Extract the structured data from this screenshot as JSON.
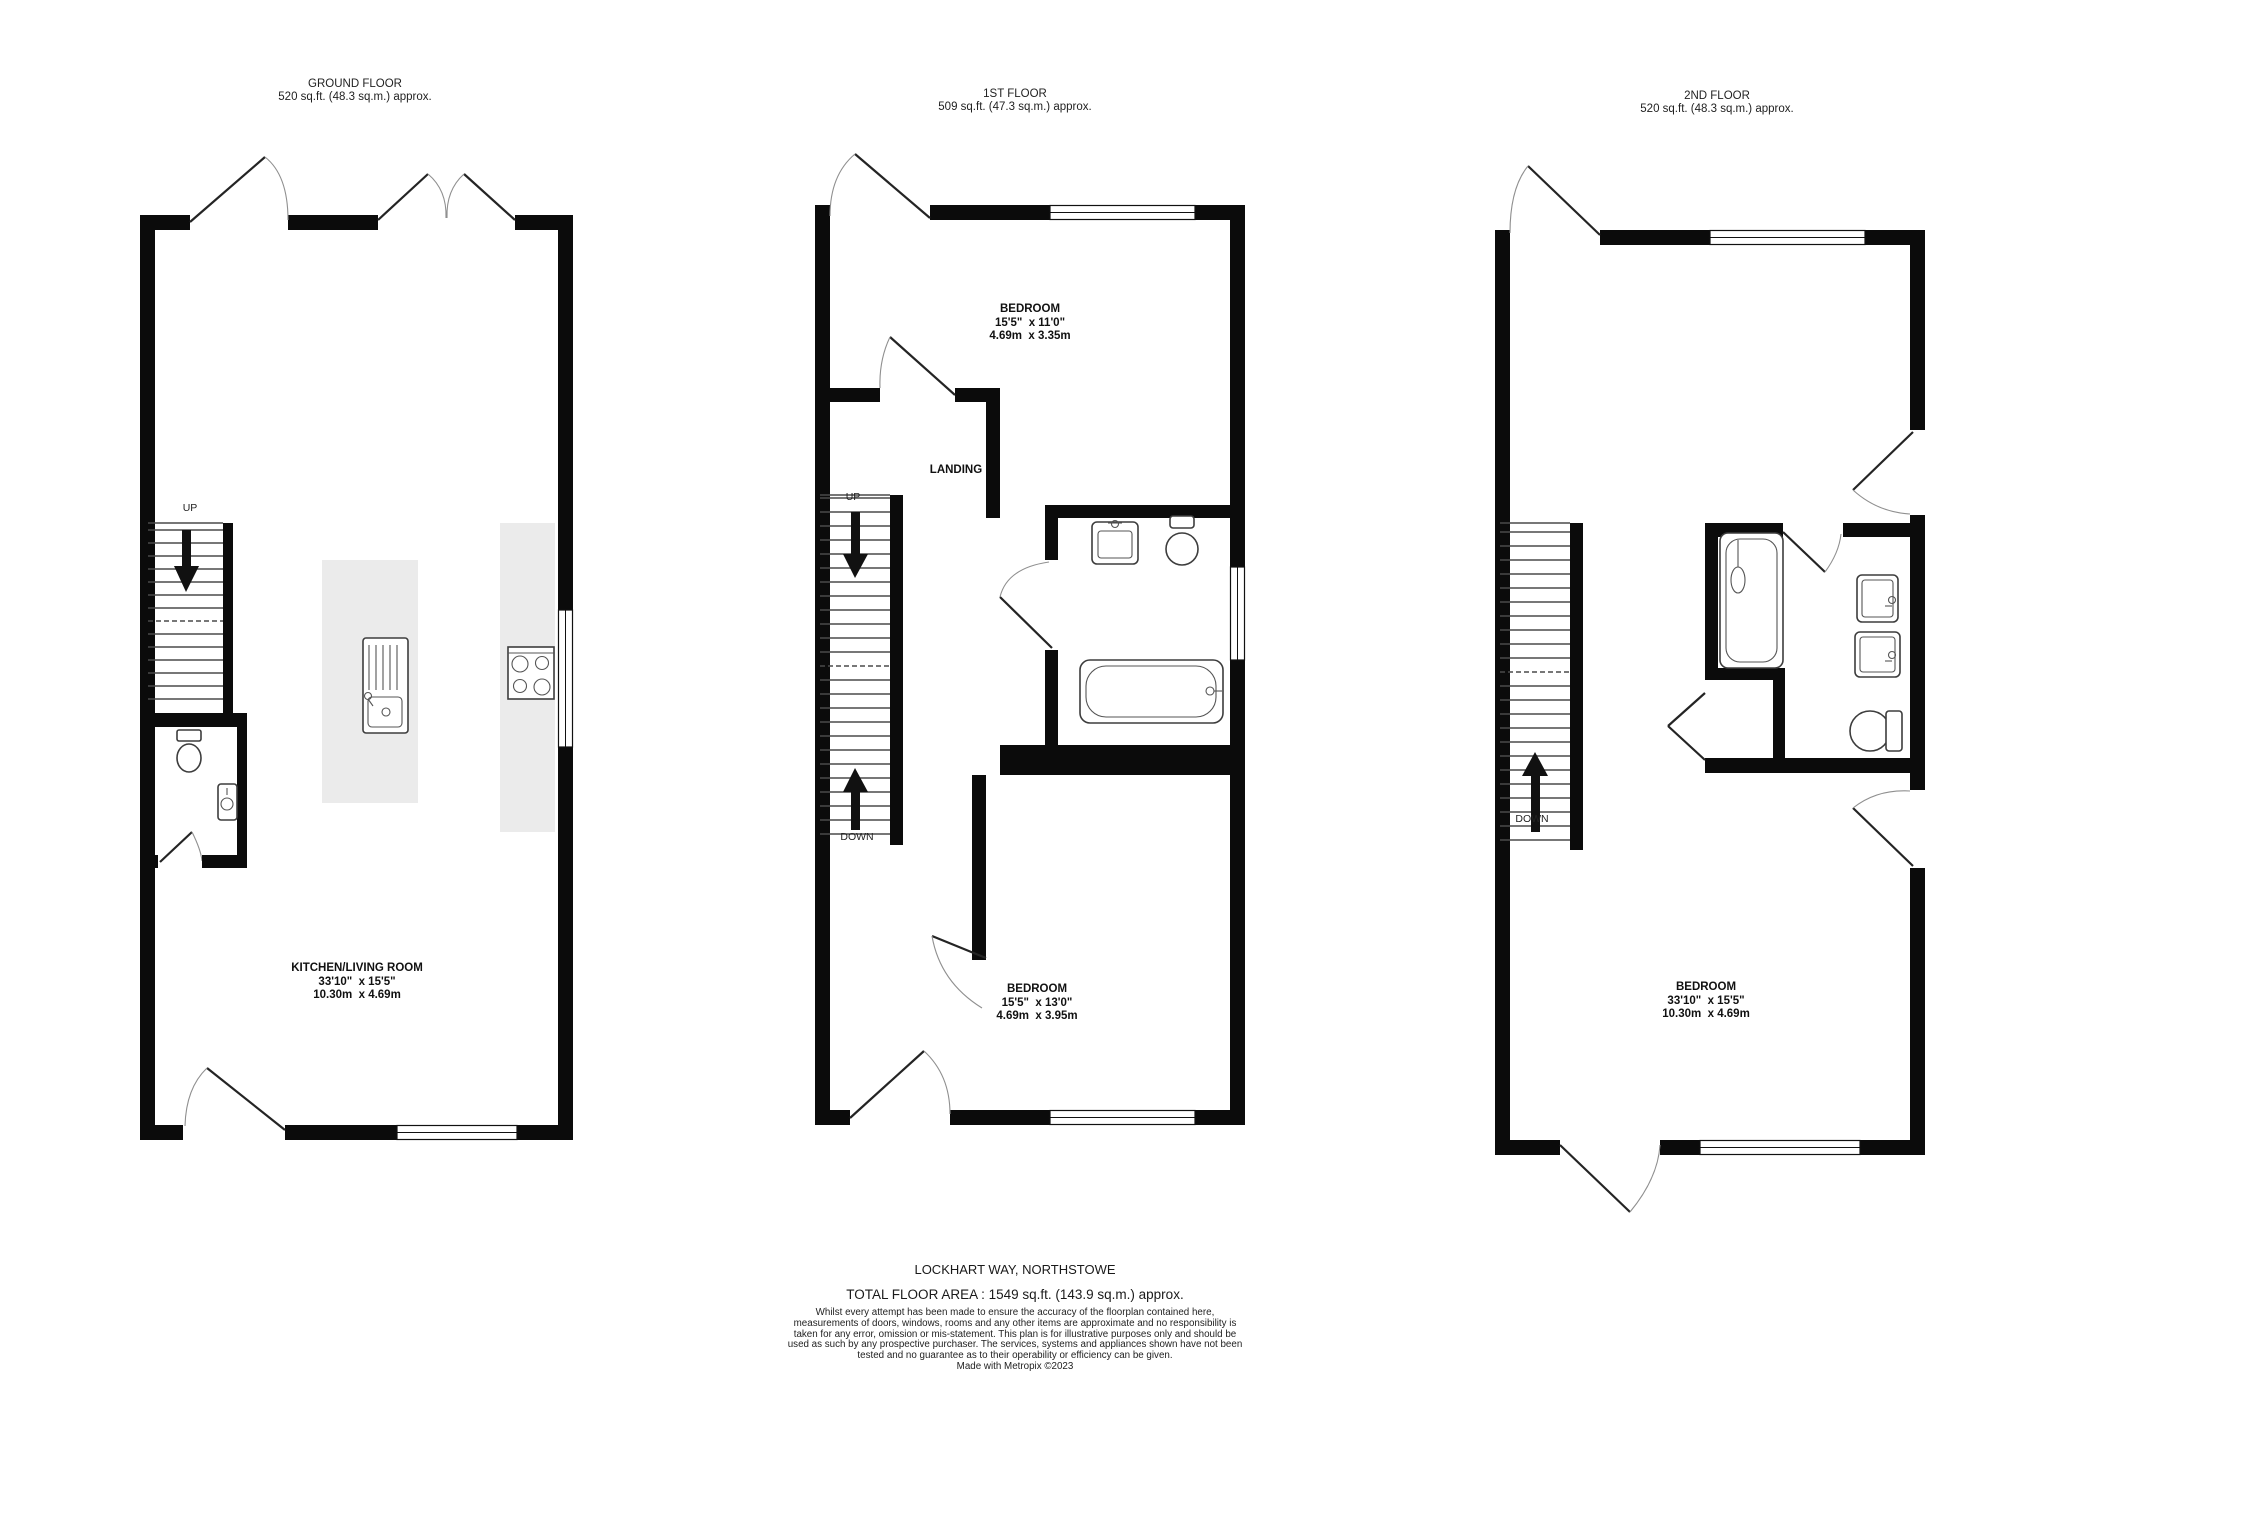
{
  "floors": [
    {
      "id": "ground",
      "title": "GROUND FLOOR",
      "area": "520 sq.ft. (48.3 sq.m.) approx.",
      "rooms": [
        {
          "name": "KITCHEN/LIVING ROOM",
          "dims_imperial": "33'10\"  x 15'5\"",
          "dims_metric": "10.30m  x 4.69m"
        }
      ],
      "stairs": {
        "up_label": "UP"
      }
    },
    {
      "id": "first",
      "title": "1ST FLOOR",
      "area": "509 sq.ft. (47.3 sq.m.) approx.",
      "rooms": [
        {
          "name": "BEDROOM",
          "dims_imperial": "15'5\"  x 11'0\"",
          "dims_metric": "4.69m  x 3.35m"
        },
        {
          "name": "LANDING"
        },
        {
          "name": "BEDROOM",
          "dims_imperial": "15'5\"  x 13'0\"",
          "dims_metric": "4.69m  x 3.95m"
        }
      ],
      "stairs": {
        "up_label": "UP",
        "down_label": "DOWN"
      }
    },
    {
      "id": "second",
      "title": "2ND FLOOR",
      "area": "520 sq.ft. (48.3 sq.m.) approx.",
      "rooms": [
        {
          "name": "BEDROOM",
          "dims_imperial": "33'10\"  x 15'5\"",
          "dims_metric": "10.30m  x 4.69m"
        }
      ],
      "stairs": {
        "down_label": "DOWN"
      }
    }
  ],
  "footer": {
    "address": "LOCKHART WAY, NORTHSTOWE",
    "total_area": "TOTAL FLOOR AREA : 1549 sq.ft. (143.9 sq.m.) approx.",
    "disclaimer": "Whilst every attempt has been made to ensure the accuracy of the floorplan contained here, measurements of doors, windows, rooms and any other items are approximate and no responsibility is taken for any error, omission or mis-statement. This plan is for illustrative purposes only and should be used as such by any prospective purchaser. The services, systems and appliances shown have not been tested and no guarantee as to their operability or efficiency can be given.",
    "credit": "Made with Metropix ©2023"
  }
}
